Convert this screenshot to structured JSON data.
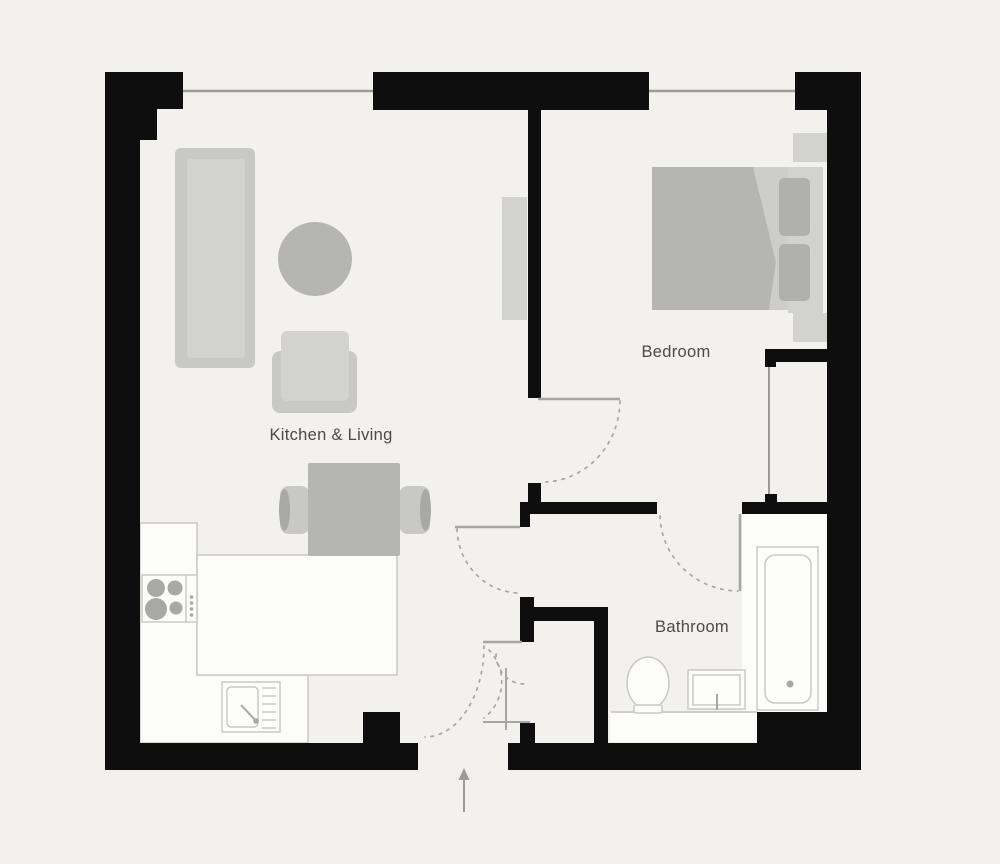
{
  "title": "One-bedroom apartment floor plan",
  "plan": {
    "rooms": [
      {
        "id": "kitchen-living",
        "label": "Kitchen & Living"
      },
      {
        "id": "bedroom",
        "label": "Bedroom"
      },
      {
        "id": "bathroom",
        "label": "Bathroom"
      }
    ],
    "windows": 2,
    "doors": [
      "entrance-door",
      "hallway-door",
      "kitchen-living-door",
      "bedroom-door",
      "bathroom-door"
    ],
    "furniture": {
      "kitchen_living": [
        "sofa",
        "coffee-table",
        "armchair",
        "radiator",
        "dining-table",
        "dining-chair-left",
        "dining-chair-right",
        "rug",
        "kitchen-counter",
        "hob",
        "kitchen-sink"
      ],
      "bedroom": [
        "double-bed",
        "pillow-top",
        "pillow-bottom",
        "headboard",
        "nightstand-top",
        "nightstand-bottom",
        "wardrobe-partition"
      ],
      "bathroom": [
        "bathtub",
        "toilet",
        "washbasin",
        "vanity-counter"
      ]
    },
    "entrance_marker": "arrow-up"
  },
  "colors": {
    "bg": "#f2f1ed",
    "wall": "#0e0e0e",
    "surface": "#fcfcfa",
    "outline": "#c9c9c6",
    "furn_mid": "#b5b5b3",
    "furn_light": "#d2d2d0",
    "furn_soft": "#c8c8c5",
    "furn_dark": "#a8a8a6",
    "pillow": "#b0b0ae",
    "fold": "#cdcdcb",
    "door": "#a6a6a4",
    "line": "#9b9b99",
    "text": "#4a4a48"
  }
}
